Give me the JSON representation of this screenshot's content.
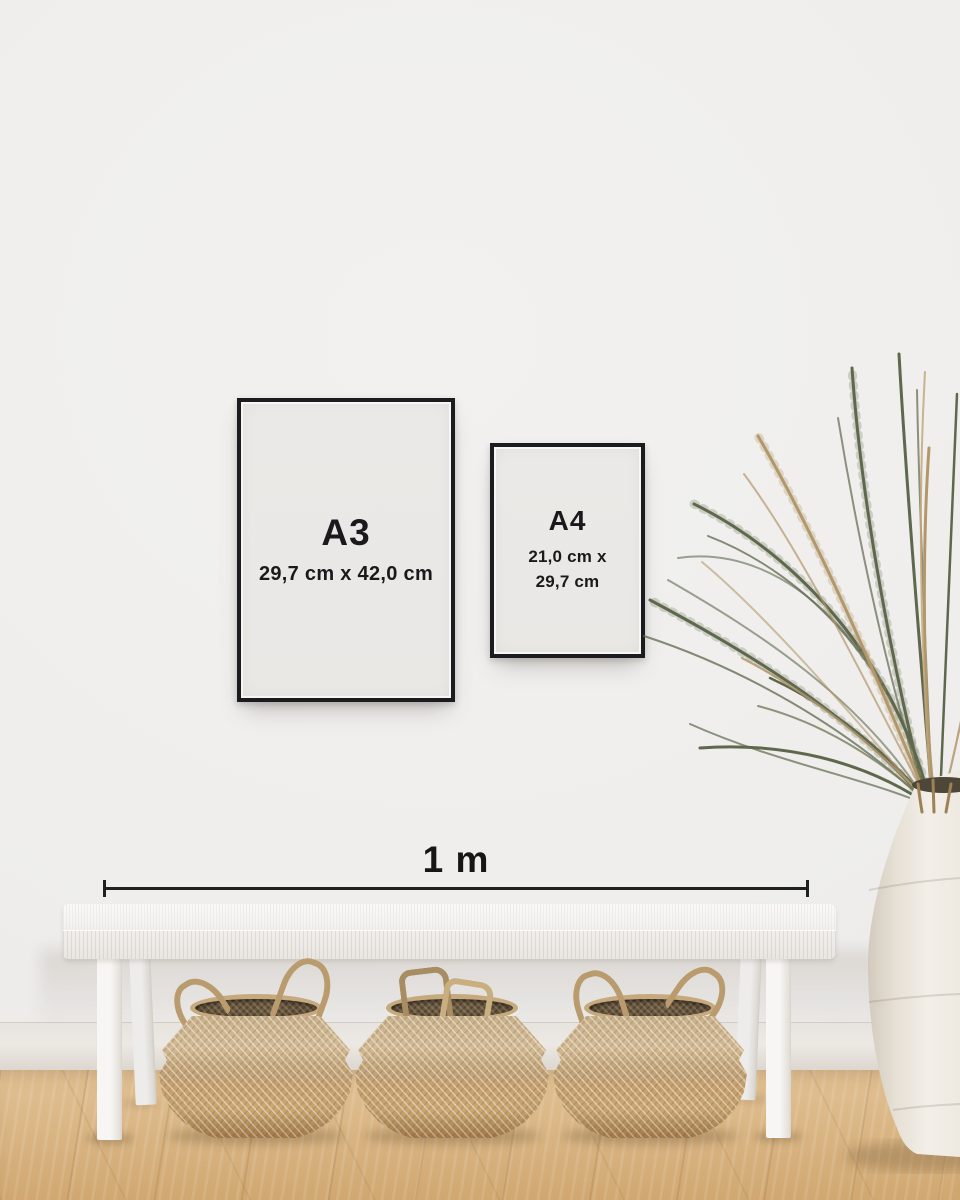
{
  "frames": [
    {
      "size_label": "A3",
      "dimensions": "29,7 cm x 42,0 cm"
    },
    {
      "size_label": "A4",
      "dimensions_lines": [
        "21,0 cm x",
        "29,7 cm"
      ]
    }
  ],
  "scale_bar": {
    "label": "1 m"
  },
  "palette": {
    "wall": "#efeeec",
    "frame_black": "#1a1c1f",
    "paper": "#e9e8e5",
    "ink": "#1a1a1c",
    "scale_line": "#202020",
    "bench_white": "#f4f2ef",
    "basket_tan": "#c5a77c",
    "basket_dark": "#5f4e3a",
    "rope": "#b99b6e",
    "plant_green": "#5e684d",
    "plant_tan": "#b2976b",
    "vase_cream": "#efeae2",
    "floor_oak": "#dab685",
    "baseboard": "#ece8e3"
  },
  "scene_objects": {
    "bench": "white-woven-bench",
    "baskets": "seagrass-belly-basket",
    "basket_count": 3,
    "plant": "dried-palm-fronds",
    "vase": "white-stone-urn",
    "floor": "oak-herringbone-floor"
  }
}
